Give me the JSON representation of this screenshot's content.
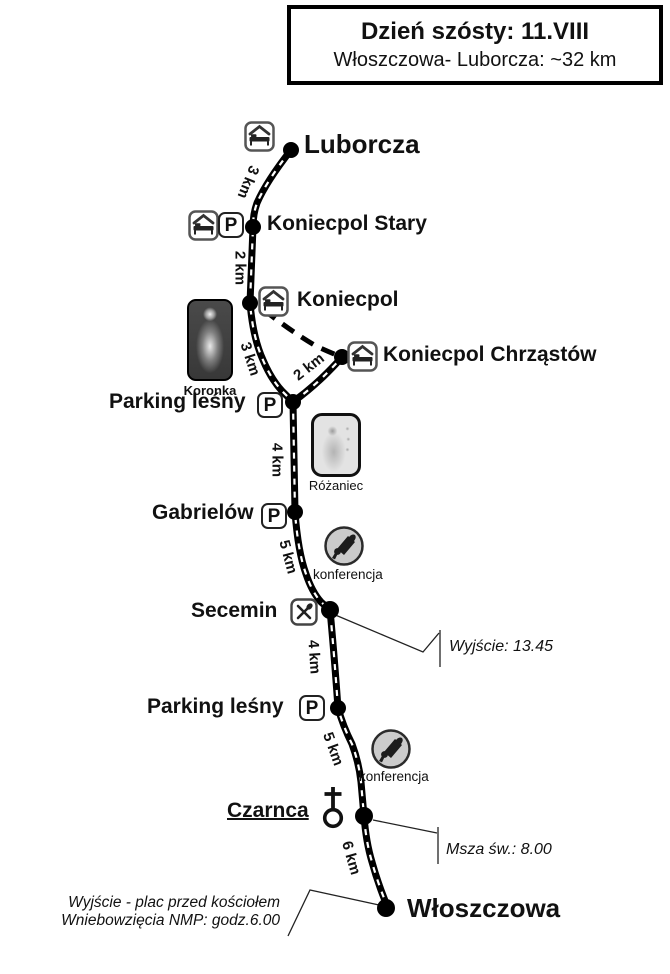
{
  "header": {
    "box_title": "Dzień szósty: 11.VIII",
    "box_subtitle": "Włoszczowa- Luborcza: ~32 km"
  },
  "stops": {
    "luborcza": {
      "label": "Luborcza"
    },
    "koniecpol_stary": {
      "label": "Koniecpol Stary"
    },
    "koniecpol": {
      "label": "Koniecpol"
    },
    "koniecpol_chrzastow": {
      "label": "Koniecpol Chrząstów"
    },
    "parking_lesny_1": {
      "label": "Parking leśny"
    },
    "gabrielow": {
      "label": "Gabrielów"
    },
    "secemin": {
      "label": "Secemin"
    },
    "parking_lesny_2": {
      "label": "Parking leśny"
    },
    "czarnca": {
      "label": "Czarnca"
    },
    "wloszczowa": {
      "label": "Włoszczowa"
    }
  },
  "distances": {
    "luborcza_koniecpol_stary": "3 km",
    "koniecpol_stary_koniecpol": "2 km",
    "koniecpol_parking_lesny": "3 km",
    "chrzastow_parking_lesny": "2 km",
    "parking_lesny_gabrielow": "4 km",
    "gabrielow_secemin": "5 km",
    "secemin_parking_lesny_2": "4 km",
    "parking_lesny_2_czarnca": "5 km",
    "czarnca_wloszczowa": "6 km"
  },
  "poi": {
    "parking_symbol": "P",
    "koronka_caption": "Koronka",
    "rozaniec_caption": "Różaniec",
    "konferencja_caption_1": "konferencja",
    "konferencja_caption_2": "konferencja"
  },
  "annotations": {
    "secemin_departure": "Wyjście: 13.45",
    "czarnca_mass": "Msza św.: 8.00",
    "start_note_line1": "Wyjście - plac przed kościołem",
    "start_note_line2": "Wniebowzięcia NMP: godz.6.00"
  },
  "colors": {
    "route": "#000000",
    "route_center_dash": "#ffffff",
    "background": "#ffffff",
    "icon_border": "#555555",
    "konferencja_fill": "#cbcbcb"
  }
}
